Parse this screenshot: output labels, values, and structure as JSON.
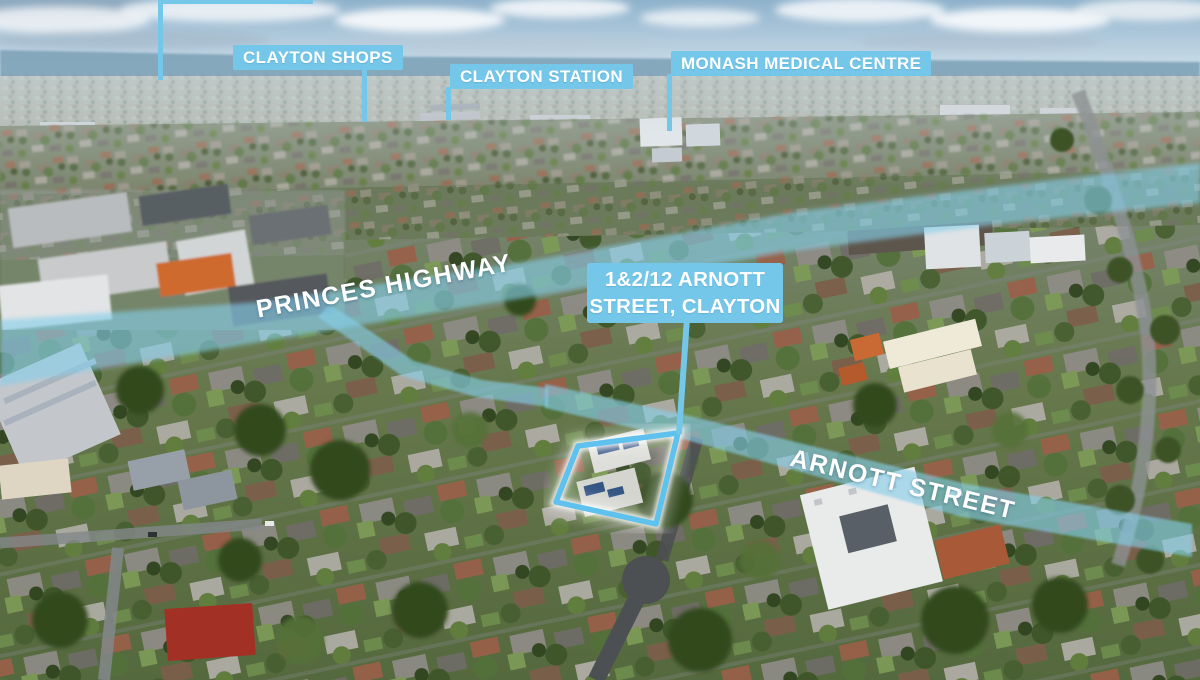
{
  "labels": {
    "shops": "CLAYTON SHOPS",
    "station": "CLAYTON STATION",
    "medical": "MONASH MEDICAL CENTRE"
  },
  "property": {
    "address_line1": "1&2/12 ARNOTT",
    "address_line2": "STREET, CLAYTON"
  },
  "roads": {
    "princes_highway": "PRINCES HIGHWAY",
    "arnott_street": "ARNOTT STREET"
  },
  "colors": {
    "label_background": "#74C7E9",
    "label_text": "#FFFFFF",
    "road_overlay": "#85CFEA",
    "property_outline": "#5FC2EE"
  }
}
